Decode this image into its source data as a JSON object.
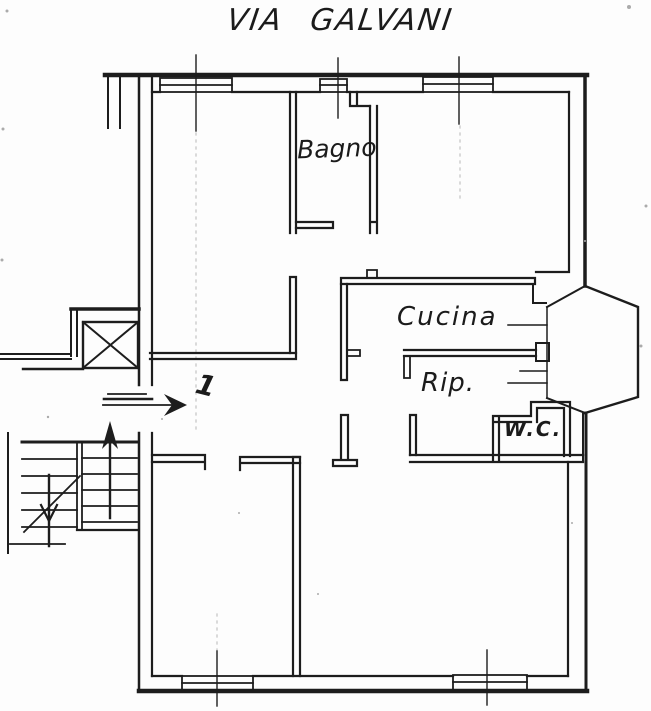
{
  "page": {
    "title": "VIA GALVANI"
  },
  "rooms": {
    "bathroom_label": "Bagno",
    "kitchen_label": "Cucina",
    "storage_label": "Rip.",
    "wc_label": "W.C."
  },
  "annotations": {
    "apartment_number": "1"
  },
  "colors": {
    "ink": "#1d1d1d",
    "paper": "#fdfdfd"
  }
}
